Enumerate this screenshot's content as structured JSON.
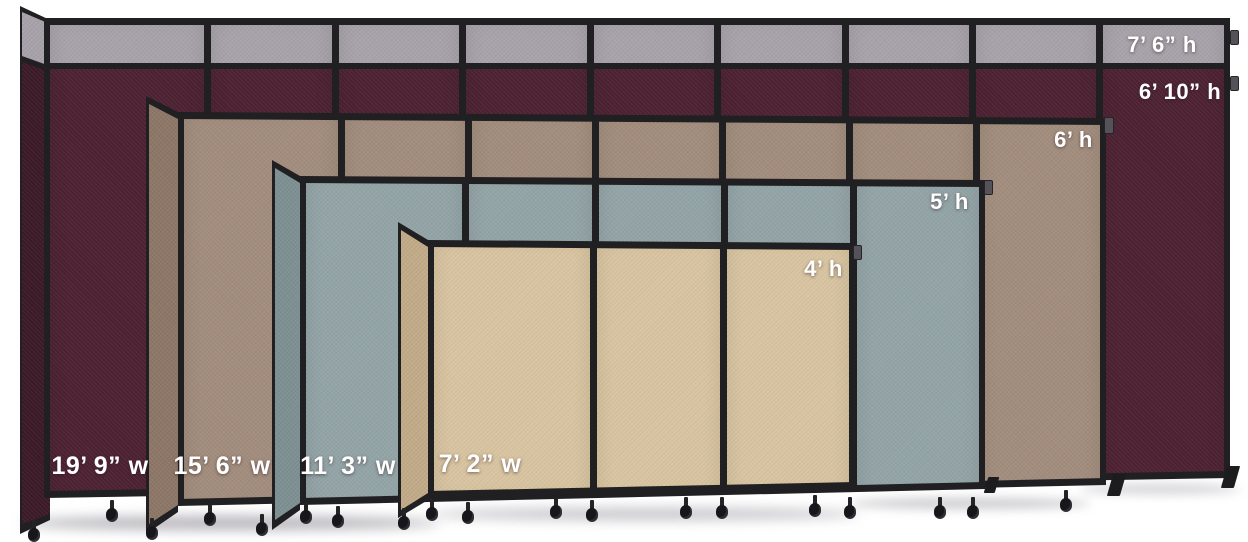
{
  "frame_color": "#201f22",
  "background_color": "#ffffff",
  "label_text_color": "#ffffff",
  "dividers": [
    {
      "face_color": "#4d2232",
      "side_color": "#3c1a28",
      "top_band_color": "#a8a2aa",
      "height_labels": [
        "7’ 6” h",
        "6’ 10” h"
      ],
      "width_label": "19’ 9” w",
      "visible_panels": 9
    },
    {
      "face_color": "#a28d7d",
      "side_color": "#8d7767",
      "height_labels": [
        "6’ h"
      ],
      "width_label": "15’ 6” w",
      "visible_panels": 7
    },
    {
      "face_color": "#93a4a7",
      "side_color": "#7e9093",
      "height_labels": [
        "5’ h"
      ],
      "width_label": "11’ 3” w",
      "visible_panels": 5
    },
    {
      "face_color": "#d8c4a0",
      "side_color": "#c2ab88",
      "height_labels": [
        "4’ h"
      ],
      "width_label": "7’ 2” w",
      "visible_panels": 3
    }
  ]
}
